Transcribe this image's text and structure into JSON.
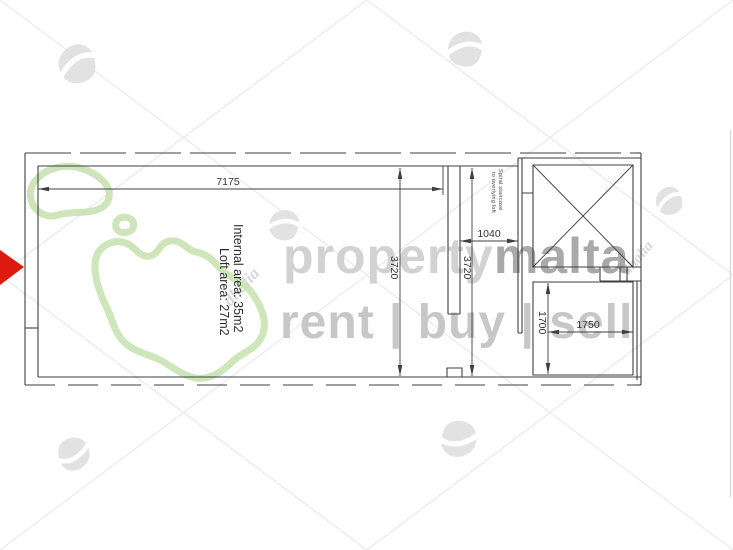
{
  "plan": {
    "line_color": "#3f3f3f",
    "dims": {
      "top_width": "7175",
      "left_height": "3720",
      "corridor_height": "3720",
      "corridor_width": "1040",
      "store_height": "1700",
      "store_width": "1750"
    },
    "labels": {
      "area_line1": "Internal area: 35m2",
      "area_line2": "Loft area: 27m2",
      "stair_line1": "Spiral staircase",
      "stair_line2": "to overlying loft"
    }
  },
  "watermark": {
    "brand_first": "property",
    "brand_second": "malta",
    "tagline": "rent | buy | sell",
    "agency_script": "dhalia",
    "colors": {
      "brand_first": "#d2d2d2",
      "brand_second": "#a9a9a9",
      "tagline": "#c7c7c7",
      "island_green": "#c8e3b2",
      "swirl_gray": "#e2e2e2",
      "swirl_cut": "#ffffff",
      "agency_gray": "#d8d8d8",
      "diagonal_gray": "#ececec"
    }
  },
  "cursor": {
    "arrow_color": "#dc1b0e"
  }
}
